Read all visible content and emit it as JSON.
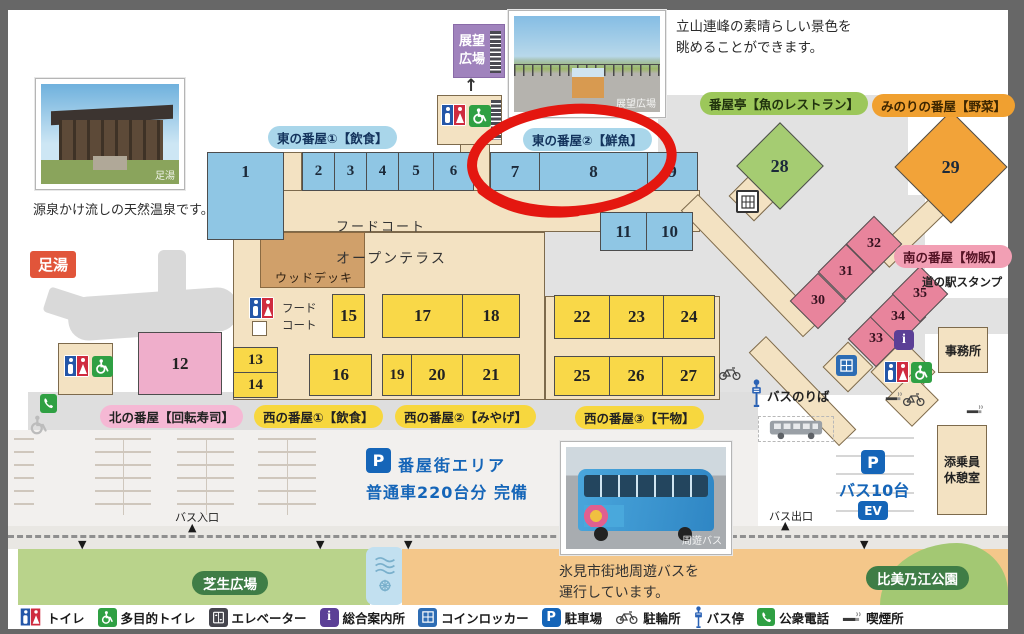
{
  "map": {
    "region_labels": {
      "observation_plaza": "展望広場",
      "ashiyu": "足湯",
      "east_banya_1": "東の番屋①【飲食】",
      "east_banya_2": "東の番屋②【鮮魚】",
      "banya_tei": "番屋亭【魚のレストラン】",
      "minori_banya": "みのりの番屋【野菜】",
      "south_banya": "南の番屋【物販】",
      "michinoeki_stamp": "道の駅スタンプ",
      "north_banya": "北の番屋【回転寿司】",
      "west_banya_1": "西の番屋①【飲食】",
      "west_banya_2": "西の番屋②【みやげ】",
      "west_banya_3": "西の番屋③【干物】",
      "food_court": "フードコート",
      "open_terrace": "オープンテラス",
      "wood_deck": "ウッドデッキ",
      "food_court_small": [
        "フード",
        "コート"
      ],
      "office": "事務所",
      "crew_lounge": "添乗員休憩室",
      "lawn_plaza": "芝生広場",
      "himinoe_park": "比美乃江公園"
    },
    "photos": {
      "onsen": {
        "caption": "源泉かけ流しの天然温泉です。",
        "watermark": "足湯"
      },
      "observation": {
        "caption": [
          "立山連峰の素晴らしい景色を",
          "眺めることができます。"
        ],
        "watermark": "展望広場"
      },
      "bus": {
        "caption": [
          "氷見市街地周遊バスを",
          "運行しています。"
        ],
        "watermark": "周遊バス"
      }
    },
    "transport": {
      "bus_stop": "バスのりば",
      "bus_entrance": "バス入口",
      "bus_exit": "バス出口",
      "bus_parking": "バス10台",
      "ev_label": "EV",
      "parking_symbol": "P",
      "parking_area": "番屋街エリア",
      "parking_capacity": "普通車220台分 完備"
    },
    "buildings": {
      "units": [
        "1",
        "2",
        "3",
        "4",
        "5",
        "6",
        "7",
        "8",
        "9",
        "10",
        "11",
        "12",
        "13",
        "14",
        "15",
        "16",
        "17",
        "18",
        "19",
        "20",
        "21",
        "22",
        "23",
        "24",
        "25",
        "26",
        "27",
        "28",
        "29",
        "30",
        "31",
        "32",
        "33",
        "34",
        "35"
      ]
    },
    "legend": [
      {
        "icon": "toilet-icon",
        "label": "トイレ"
      },
      {
        "icon": "accessible-toilet-icon",
        "label": "多目的トイレ"
      },
      {
        "icon": "elevator-icon",
        "label": "エレベーター"
      },
      {
        "icon": "information-icon",
        "label": "総合案内所"
      },
      {
        "icon": "coin-locker-icon",
        "label": "コインロッカー"
      },
      {
        "icon": "parking-icon",
        "label": "駐車場"
      },
      {
        "icon": "bicycle-parking-icon",
        "label": "駐輪所"
      },
      {
        "icon": "bus-stop-icon",
        "label": "バス停"
      },
      {
        "icon": "public-phone-icon",
        "label": "公衆電話"
      },
      {
        "icon": "smoking-area-icon",
        "label": "喫煙所"
      }
    ],
    "annotation": {
      "type": "hand-drawn-ellipse",
      "color": "#e41710",
      "circles": "東の番屋②【鮮魚】 7・8"
    },
    "colors": {
      "east_banya_blue": "#8fc6e4",
      "west_banya_yellow": "#f9d848",
      "north_banya_pink": "#efaecb",
      "south_banya_rose": "#e8849c",
      "banya_tei_green": "#a5cc72",
      "minori_orange": "#f2a339",
      "walkway_tan": "#f3e2c2",
      "parking_text_blue": "#1565b8",
      "lawn_green": "#b9d38b",
      "road_orange": "#f4c78a",
      "annotation_red": "#e41710"
    }
  }
}
